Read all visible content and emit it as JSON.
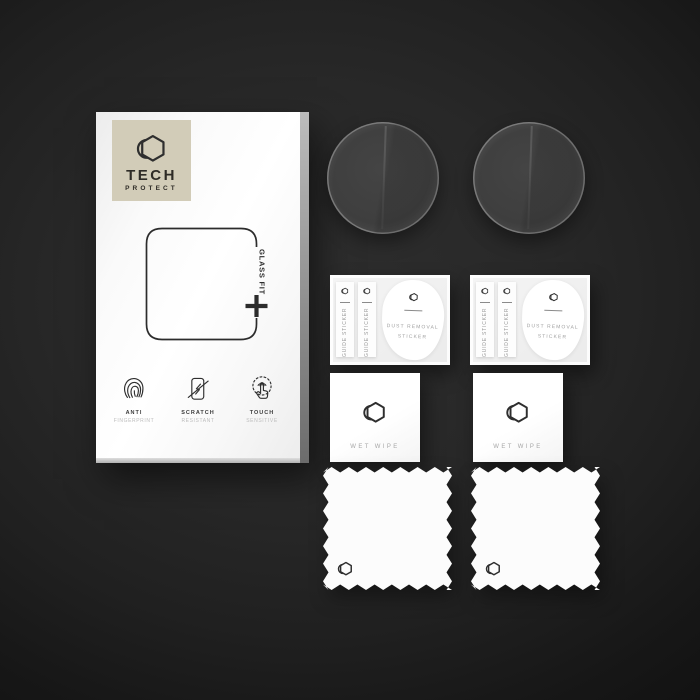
{
  "colors": {
    "background_center": "#2e2e2e",
    "background_edge": "#121212",
    "brand_beige": "#d2ccb8",
    "ink": "#2e2e2e",
    "muted_gray": "#9a9a9a",
    "paper_white": "#fafafa"
  },
  "icons": {
    "brand_logo": "hexagon-crescent-icon",
    "feature_icons": [
      "fingerprint-icon",
      "scratch-resistant-icon",
      "touch-sensitive-icon"
    ],
    "alignment_mark": "plus-icon"
  },
  "box": {
    "brand": {
      "line1": "TECH",
      "line2": "PROTECT"
    },
    "glass_fit_label": "GLASS FIT",
    "features": [
      {
        "title": "ANTI",
        "subtitle": "FINGERPRINT"
      },
      {
        "title": "SCRATCH",
        "subtitle": "RESISTANT"
      },
      {
        "title": "TOUCH",
        "subtitle": "SENSITIVE"
      }
    ]
  },
  "sticker_sheet": {
    "guide_label": "GUIDE STICKER",
    "dust_line1": "DUST REMOVAL",
    "dust_line2": "STICKER"
  },
  "wet_wipe": {
    "label": "WET WIPE"
  },
  "contents": {
    "glass_disc_count": 2,
    "sticker_sheet_count": 2,
    "wet_wipe_count": 2,
    "cleaning_cloth_count": 2
  }
}
